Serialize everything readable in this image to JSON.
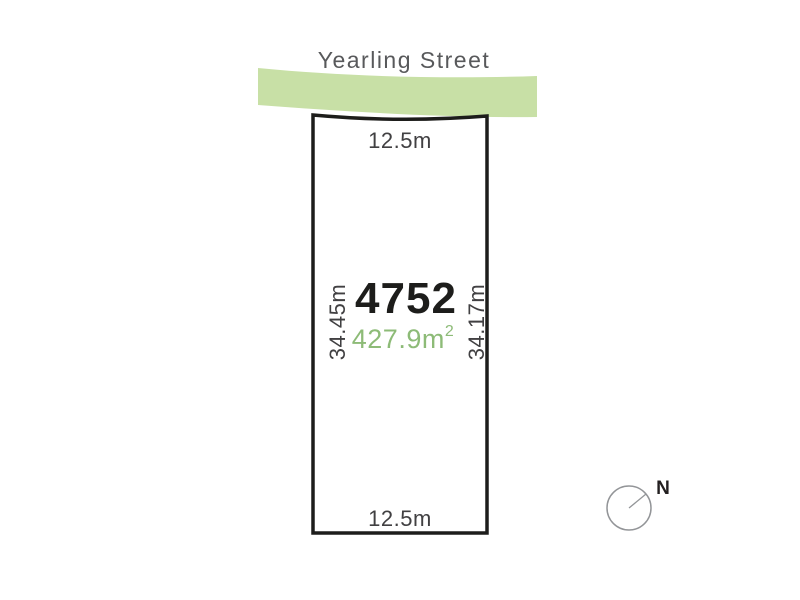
{
  "diagram": {
    "street": {
      "name": "Yearling Street"
    },
    "lot": {
      "number": "4752",
      "area_value": "427.9m",
      "area_superscript": "2",
      "top_width": "12.5m",
      "bottom_width": "12.5m",
      "left_length": "34.45m",
      "right_length": "34.17m"
    },
    "compass": {
      "north_label": "N"
    }
  },
  "colors": {
    "street_band": "#c8e0a6",
    "street_name_text": "#58595b",
    "dimension_text": "#414042",
    "lot_number_text": "#1d1d1b",
    "area_text": "#8dbb77",
    "lot_border": "#1d1d1b",
    "lot_fill": "#ffffff",
    "compass_stroke": "#939598",
    "compass_text": "#231f20",
    "background": "#ffffff"
  }
}
